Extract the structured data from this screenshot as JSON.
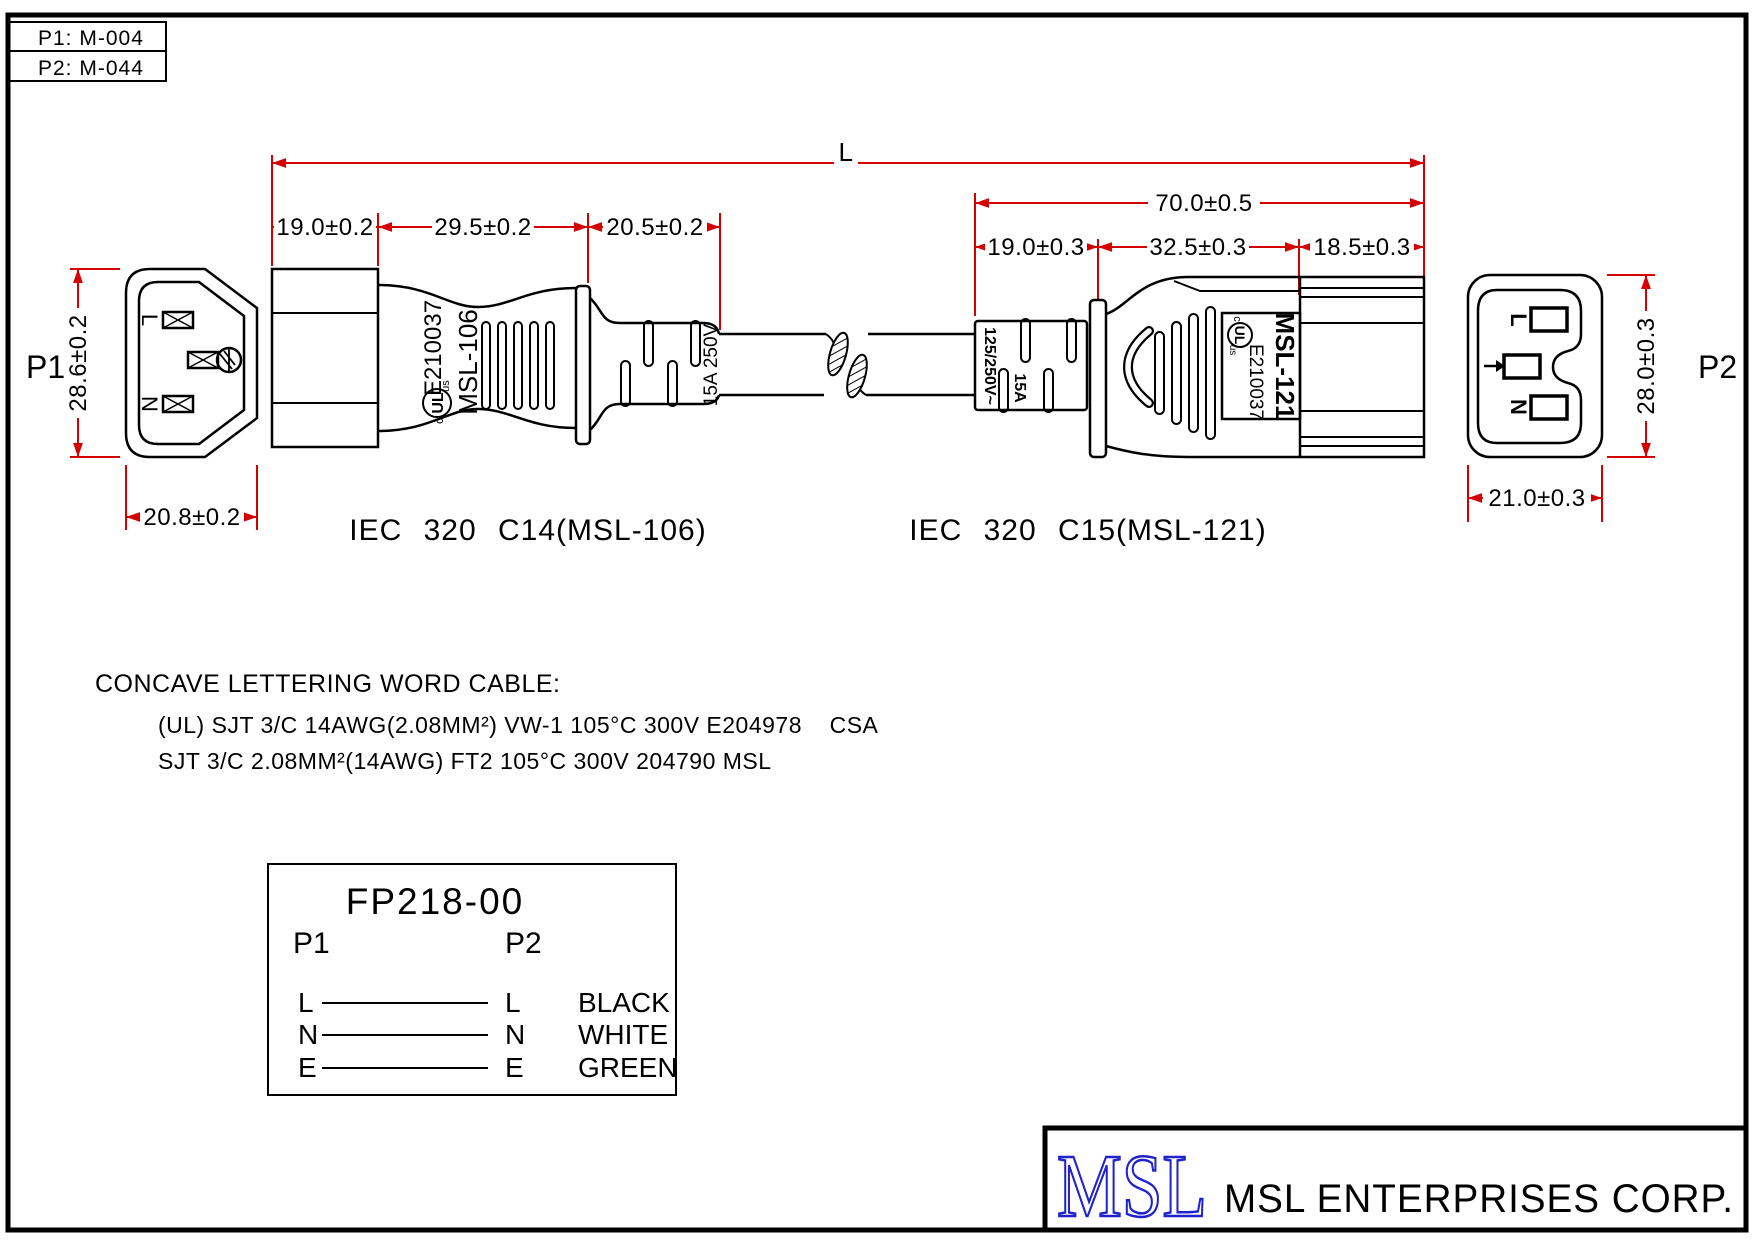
{
  "colors": {
    "dimension_red": "#d40000",
    "logo_blue": "#2222cc",
    "line_black": "#000000"
  },
  "title_block": {
    "p1_ref": "P1: M-004",
    "p2_ref": "P2: M-044"
  },
  "dimensions": {
    "overall_length": "L",
    "c15_overall": "70.0±0.5",
    "c14": {
      "seg1": "19.0±0.2",
      "seg2": "29.5±0.2",
      "seg3": "20.5±0.2",
      "height": "28.6±0.2",
      "width": "20.8±0.2"
    },
    "c15": {
      "seg1": "19.0±0.3",
      "seg2": "32.5±0.3",
      "seg3": "18.5±0.3",
      "height": "28.0±0.3",
      "width": "21.0±0.3"
    }
  },
  "connectors": {
    "p1": {
      "label": "P1",
      "caption": "IEC 320 C14(MSL-106)",
      "pins": {
        "live": "L",
        "neutral": "N"
      }
    },
    "p2": {
      "label": "P2",
      "caption": "IEC 320 C15(MSL-121)",
      "pins": {
        "live": "L",
        "neutral": "N"
      }
    }
  },
  "markings": {
    "c14_cert": "E210037",
    "c14_model": "MSL-106",
    "c14_rating": "15A 250V",
    "c15_rating_voltage": "125/250V~",
    "c15_rating_current": "15A",
    "c15_cert": "E210037",
    "c15_model": "MSL-121",
    "ul_c": "c",
    "ul_core": "UL",
    "ul_us": "us"
  },
  "cable_note": {
    "title": "CONCAVE LETTERING WORD CABLE:",
    "line1": "(UL) SJT 3/C 14AWG(2.08MM²) VW-1 105°C 300V E204978    CSA",
    "line2": "SJT 3/C 2.08MM²(14AWG) FT2 105°C 300V 204790 MSL"
  },
  "wiring": {
    "part_number": "FP218-00",
    "col1": "P1",
    "col2": "P2",
    "rows": [
      {
        "from": "L",
        "to": "L",
        "wire": "BLACK"
      },
      {
        "from": "N",
        "to": "N",
        "wire": "WHITE"
      },
      {
        "from": "E",
        "to": "E",
        "wire": "GREEN"
      }
    ]
  },
  "footer": {
    "logo": "MSL",
    "company": "MSL ENTERPRISES CORP."
  }
}
